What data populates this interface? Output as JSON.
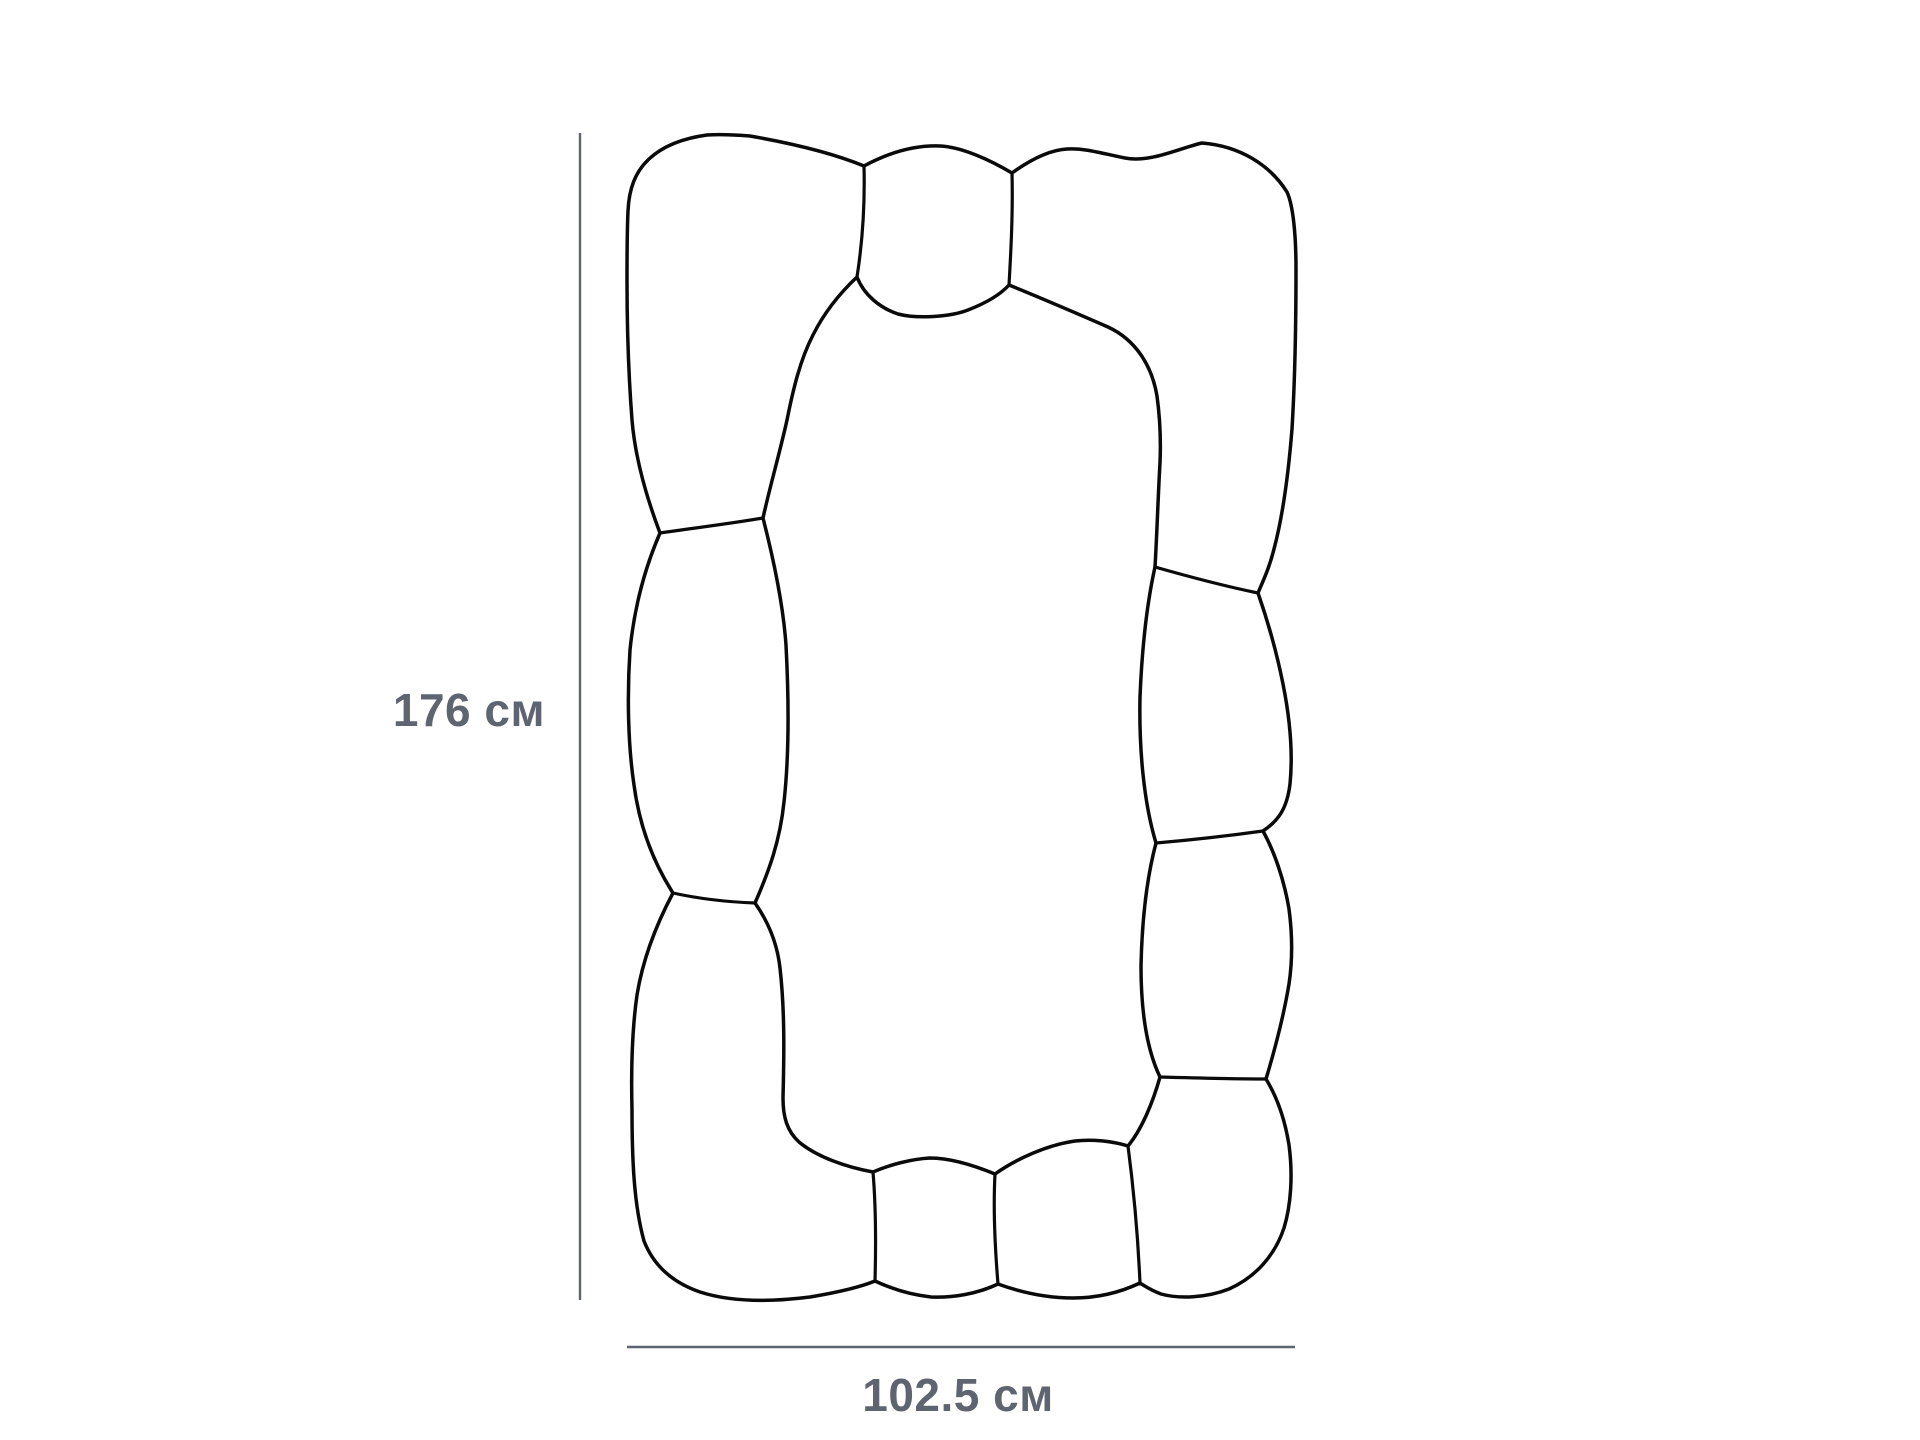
{
  "page": {
    "background": "#ffffff"
  },
  "colors": {
    "drawing_stroke": "#0a0a0a",
    "dimension_color": "#5e6470"
  },
  "dimensions": {
    "height_label": "176 см",
    "width_label": "102.5 см",
    "height_value": "176",
    "width_value": "102.5",
    "unit": "см"
  }
}
